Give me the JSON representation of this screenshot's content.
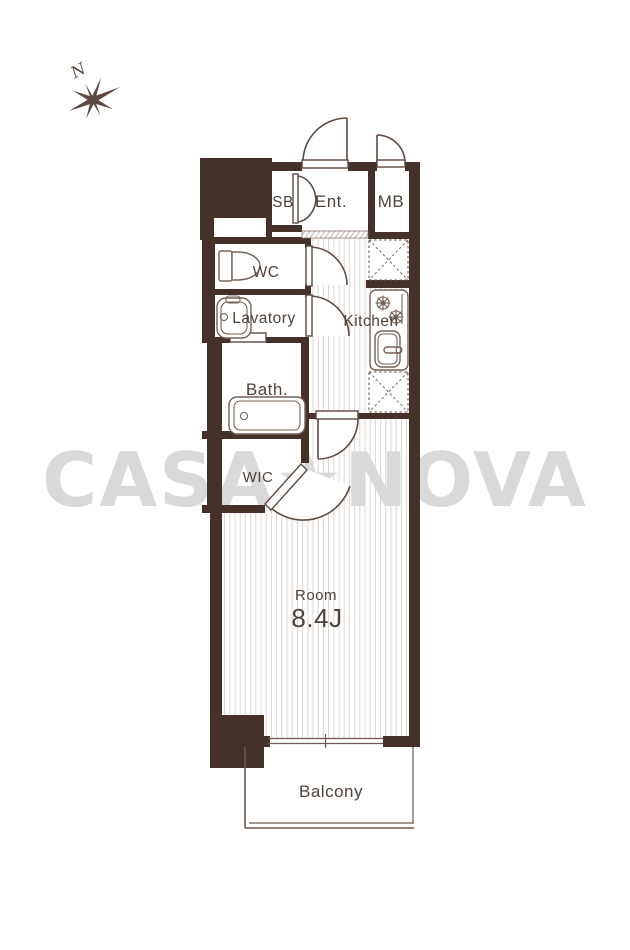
{
  "title": "Apartment floor plan",
  "compass": {
    "label": "N"
  },
  "watermark": {
    "text": "CASA★NOVA",
    "color": "#d9d9d9"
  },
  "rooms": {
    "sb": "SB",
    "entrance": "Ent.",
    "mb": "MB",
    "wc": "WC",
    "lavatory": "Lavatory",
    "kitchen": "Kitchen",
    "bath": "Bath.",
    "wic": "WIC",
    "room_label": "Room",
    "room_size": "8.4J",
    "balcony": "Balcony"
  },
  "colors": {
    "wall": "#46312a",
    "line": "#5e4a40",
    "text": "#4f423b",
    "floor_stripe": "#ddd5cf",
    "watermark": "#d9d9d9"
  }
}
